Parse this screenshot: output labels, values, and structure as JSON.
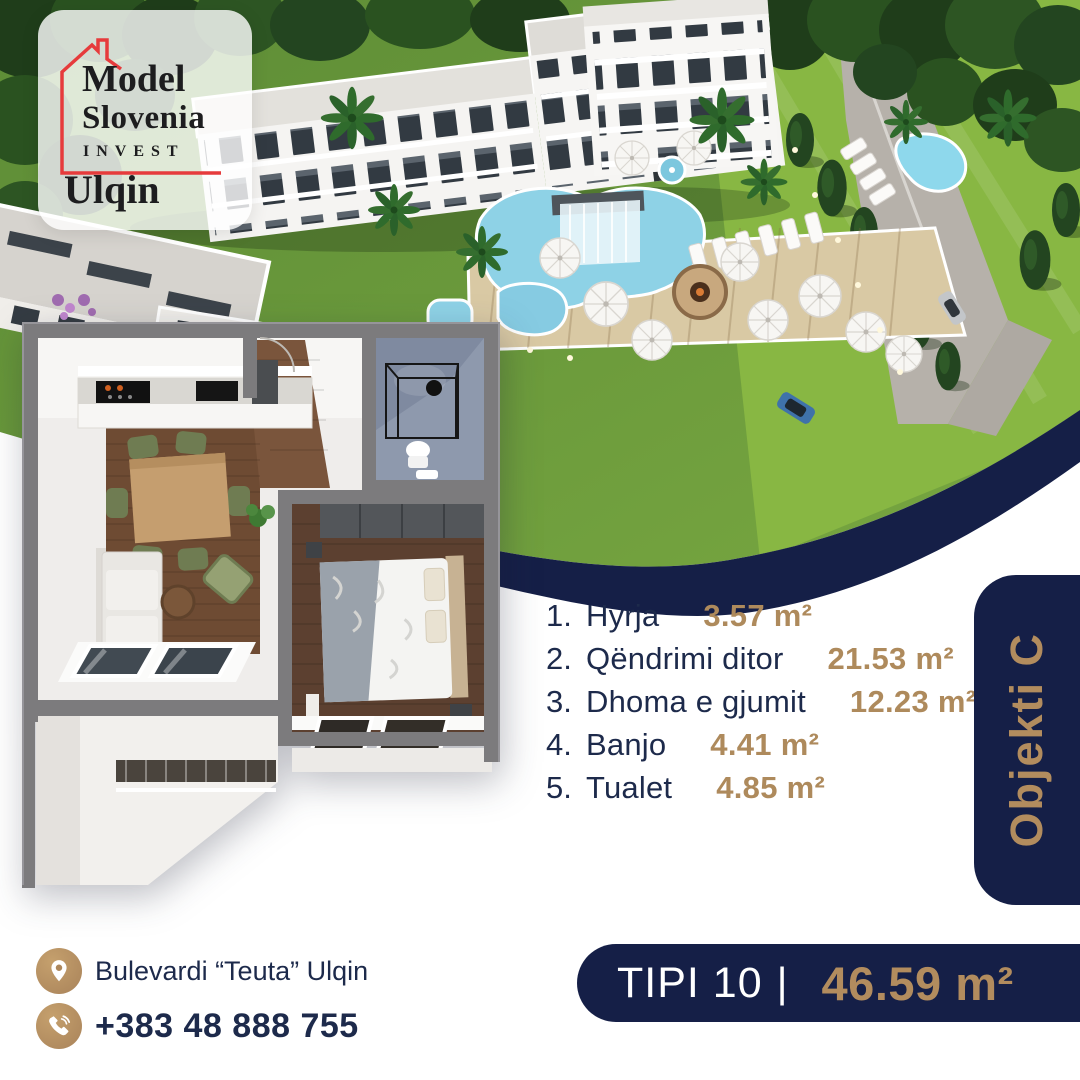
{
  "logo": {
    "line1": "Model",
    "line2": "Slovenia",
    "line3": "INVEST",
    "line4": "Ulqin"
  },
  "rooms": [
    {
      "num": "1.",
      "label": "Hyrja",
      "area": "3.57 m²"
    },
    {
      "num": "2.",
      "label": "Qëndrimi ditor",
      "area": "21.53 m²"
    },
    {
      "num": "3.",
      "label": "Dhoma e gjumit",
      "area": "12.23 m²"
    },
    {
      "num": "4.",
      "label": "Banjo",
      "area": "4.41 m²"
    },
    {
      "num": "5.",
      "label": "Tualet",
      "area": "4.85 m²"
    }
  ],
  "object_label": "Objekti C",
  "type_banner": {
    "type": "TIPI 10",
    "separator": "|",
    "total_area": "46.59 m²"
  },
  "contact": {
    "address": "Bulevardi “Teuta” Ulqin",
    "phone": "+383 48 888 755"
  },
  "colors": {
    "navy": "#151f47",
    "gold": "#b28c5e",
    "red": "#e63b3c",
    "navy_text": "#1d2a4b"
  }
}
